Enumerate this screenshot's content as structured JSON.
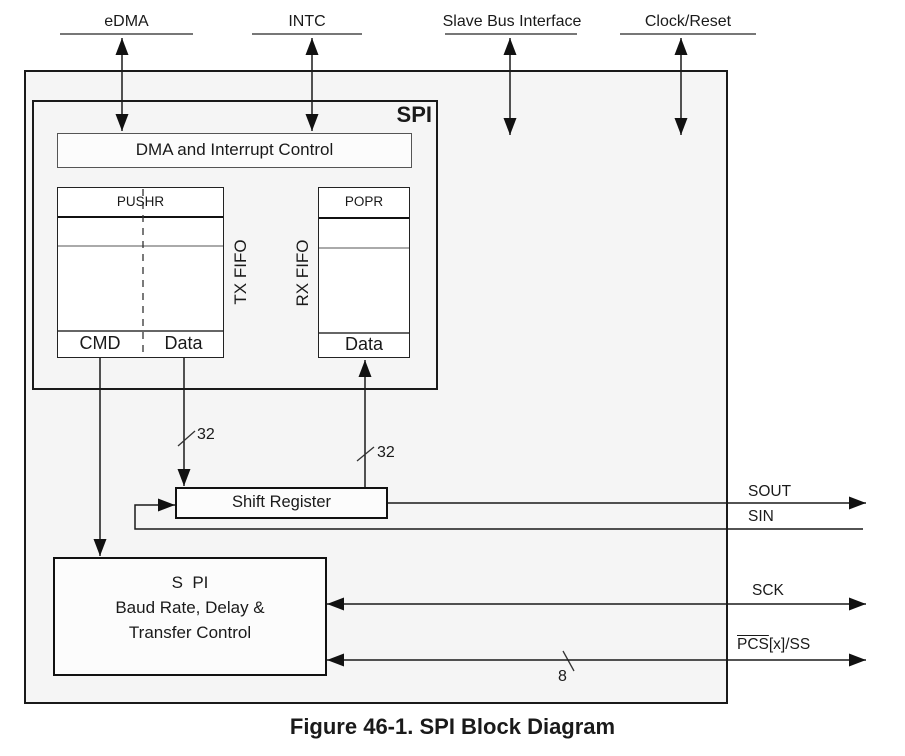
{
  "top_ports": {
    "edma": "eDMA",
    "intc": "INTC",
    "slave_bus": "Slave Bus Interface",
    "clock_reset": "Clock/Reset"
  },
  "spi": {
    "title": "SPI",
    "dma_interrupt_control": "DMA and Interrupt Control",
    "tx_fifo": {
      "register": "PUSHR",
      "label": "TX FIFO",
      "cmd": "CMD",
      "data": "Data"
    },
    "rx_fifo": {
      "register": "POPR",
      "label": "RX FIFO",
      "data": "Data"
    }
  },
  "shift_register": {
    "label": "Shift Register"
  },
  "baud_block": {
    "line1": "S  PI",
    "line2": "Baud Rate, Delay &",
    "line3": "Transfer Control"
  },
  "signals": {
    "sout": "SOUT",
    "sin": "SIN",
    "sck": "SCK",
    "pcs_over": "PCS",
    "pcs_rest": "[x]/SS"
  },
  "bus_widths": {
    "tx": "32",
    "rx": "32",
    "pcs": "8"
  },
  "caption": "Figure 46-1. SPI Block Diagram",
  "colors": {
    "box_fill": "#f5f5f5",
    "line": "#1a1a1a"
  }
}
